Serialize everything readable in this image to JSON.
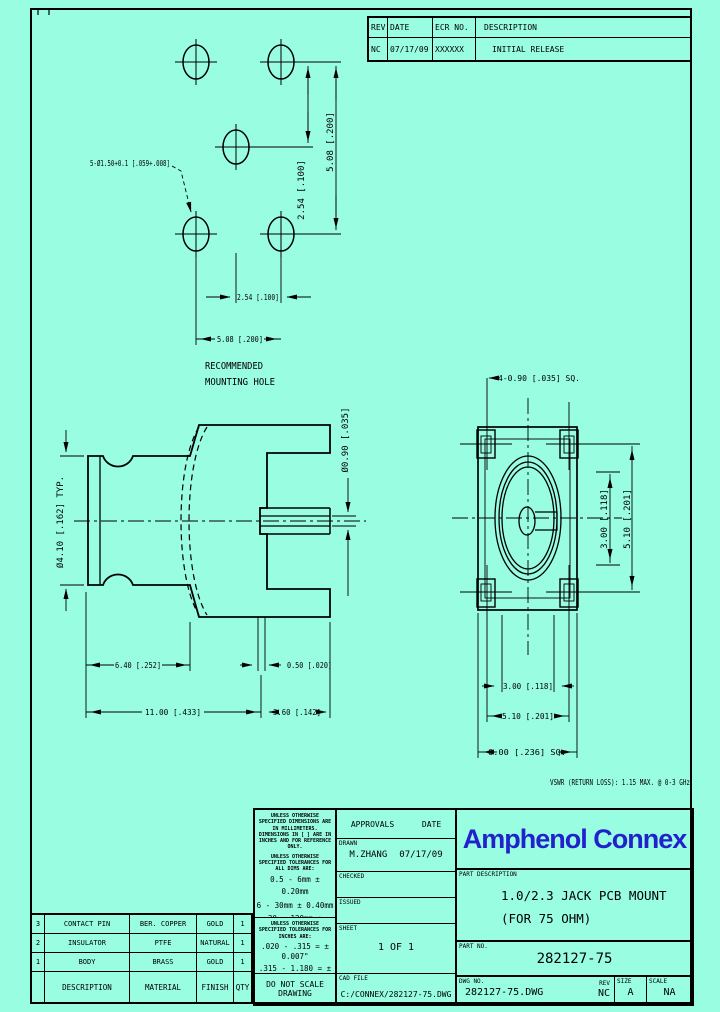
{
  "page": {
    "background": "#99fde2",
    "brand_color": "#2222cc"
  },
  "revision_table": {
    "headers": {
      "rev": "REV.",
      "date": "DATE",
      "ecr": "ECR NO.",
      "description": "DESCRIPTION"
    },
    "row": {
      "rev": "NC",
      "date": "07/17/09",
      "ecr": "XXXXXX",
      "description": "INITIAL RELEASE"
    }
  },
  "drawing": {
    "mounting": {
      "callout": "5-Ø1.50+0.1 [.059+.008]",
      "dim_v_pitch": "2.54 [.100]",
      "dim_v_span": "5.08 [.200]",
      "dim_h_pitch": "2.54 [.100]",
      "dim_h_span": "5.08 [.200]",
      "caption_line1": "RECOMMENDED",
      "caption_line2": "MOUNTING HOLE"
    },
    "side_view": {
      "dim_body_dia": "Ø4.10 [.162] TYP.",
      "dim_pin_dia": "Ø0.90 [.035]",
      "dim_rear_len": "6.40 [.252]",
      "dim_leg": "0.50 [.020]",
      "dim_total_len": "11.00 [.433]",
      "dim_front_len": "3.60 [.142]"
    },
    "front_view": {
      "dim_pins": "4-0.90 [.035] SQ.",
      "dim_v_inner": "3.00 [.118]",
      "dim_v_pins": "5.10 [.201]",
      "dim_h_inner": "3.00 [.118]",
      "dim_h_pins": "5.10 [.201]",
      "dim_body": "6.00 [.236] SQ.",
      "vswr_note": "VSWR (RETURN LOSS): 1.15 MAX. @ 0-3 GHz"
    }
  },
  "title_block": {
    "notes": {
      "units_note": "UNLESS OTHERWISE SPECIFIED DIMENSIONS ARE IN MILLIMETERS. DIMENSIONS IN [ ] ARE IN INCHES AND FOR REFERENCE ONLY.",
      "mm_tol_intro": "UNLESS OTHERWISE SPECIFIED TOLERANCES FOR ALL DIMS ARE:",
      "mm_tols": [
        "0.5 - 6mm ± 0.20mm",
        "6 - 30mm ± 0.40mm",
        "30 - 120mm ± 0.50mm"
      ],
      "inch_tol_intro": "UNLESS OTHERWISE SPECIFIED TOLERANCES FOR INCHES ARE:",
      "inch_tols": [
        ".020 - .315 = ± 0.007\"",
        ".315 - 1.180 = ± 0.015\"",
        "1.180 - 4.724 = ± 0.020\""
      ],
      "do_not_scale": "DO NOT SCALE DRAWING"
    },
    "approvals": {
      "title": "APPROVALS",
      "date_header": "DATE",
      "drawn_label": "DRAWN",
      "drawn_by": "M.ZHANG",
      "drawn_date": "07/17/09",
      "checked_label": "CHECKED",
      "issued_label": "ISSUED",
      "sheet_label": "SHEET",
      "sheet_value": "1 OF 1",
      "cad_file_label": "CAD FILE",
      "cad_file": "C:/CONNEX/282127-75.DWG"
    },
    "company": "Amphenol Connex",
    "part_description_label": "PART DESCRIPTION",
    "part_description": [
      "1.0/2.3 JACK PCB MOUNT",
      "(FOR 75 OHM)"
    ],
    "part_no_label": "PART NO.",
    "part_no": "282127-75",
    "dwg_no_label": "DWG NO.",
    "dwg_no": "282127-75.DWG",
    "rev_label": "REV",
    "rev": "NC",
    "size_label": "SIZE",
    "size": "A",
    "scale_label": "SCALE",
    "scale": "NA"
  },
  "materials_table": {
    "headers": {
      "description": "DESCRIPTION",
      "material": "MATERIAL",
      "finish": "FINISH",
      "qty": "QTY"
    },
    "rows": [
      {
        "item": "3",
        "description": "CONTACT PIN",
        "material": "BER. COPPER",
        "finish": "GOLD",
        "qty": "1"
      },
      {
        "item": "2",
        "description": "INSULATOR",
        "material": "PTFE",
        "finish": "NATURAL",
        "qty": "1"
      },
      {
        "item": "1",
        "description": "BODY",
        "material": "BRASS",
        "finish": "GOLD",
        "qty": "1"
      }
    ]
  }
}
